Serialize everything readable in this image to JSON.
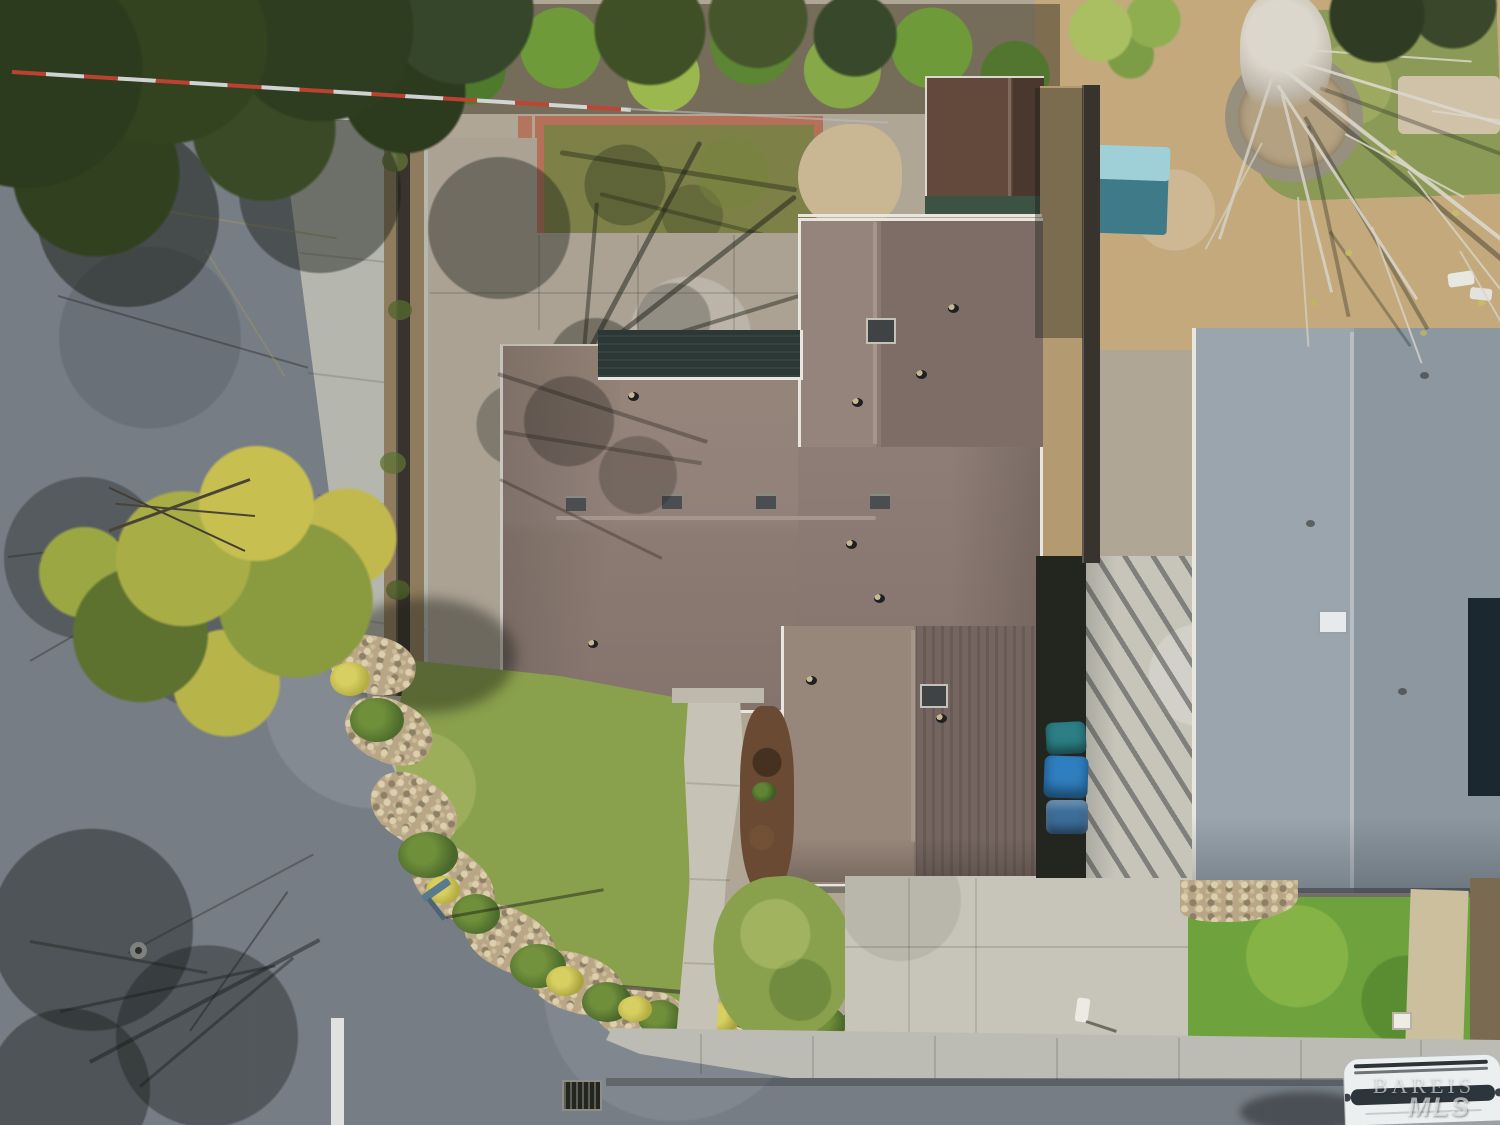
{
  "watermark": {
    "line1": "BAREIS",
    "line2": "MLS"
  },
  "colors": {
    "asphalt": "#767d85",
    "asphalt_light": "#8d939a",
    "sidewalk": "#b5b6ae",
    "driveway": "#c7c5ba",
    "patio": "#aba294",
    "patio_left": "#9c948a",
    "roof_light": "#97867c",
    "roof_base": "#8b7a73",
    "roof_dark": "#72635c",
    "roof_ridge": "#a5958a",
    "roof_gray": "#9aa5ad",
    "roof_gray_dark": "#7d8791",
    "white_trim": "#e9e6df",
    "lawn": "#89a04c",
    "lawn_light": "#a9b15d",
    "lawn_bright": "#6da23c",
    "back_lawn": "#7d8148",
    "dirt": "#c3a97c",
    "mulch": "#6a4a33",
    "brick": "#b47058",
    "rock": "#b9a686",
    "canopy": "#2f3e1e",
    "foliage_yellow": "#c3bc4f",
    "foliage_green": "#6c8a3a",
    "fence": "#38332c",
    "shade_roof": "#2b3835",
    "shed_roof": "#5d4739",
    "bin_blue": "#2f7fc0",
    "bin_teal": "#2c7f85",
    "car_white": "#eceff0",
    "skylight": "#3f4346",
    "stop_line": "#e8eae7"
  }
}
